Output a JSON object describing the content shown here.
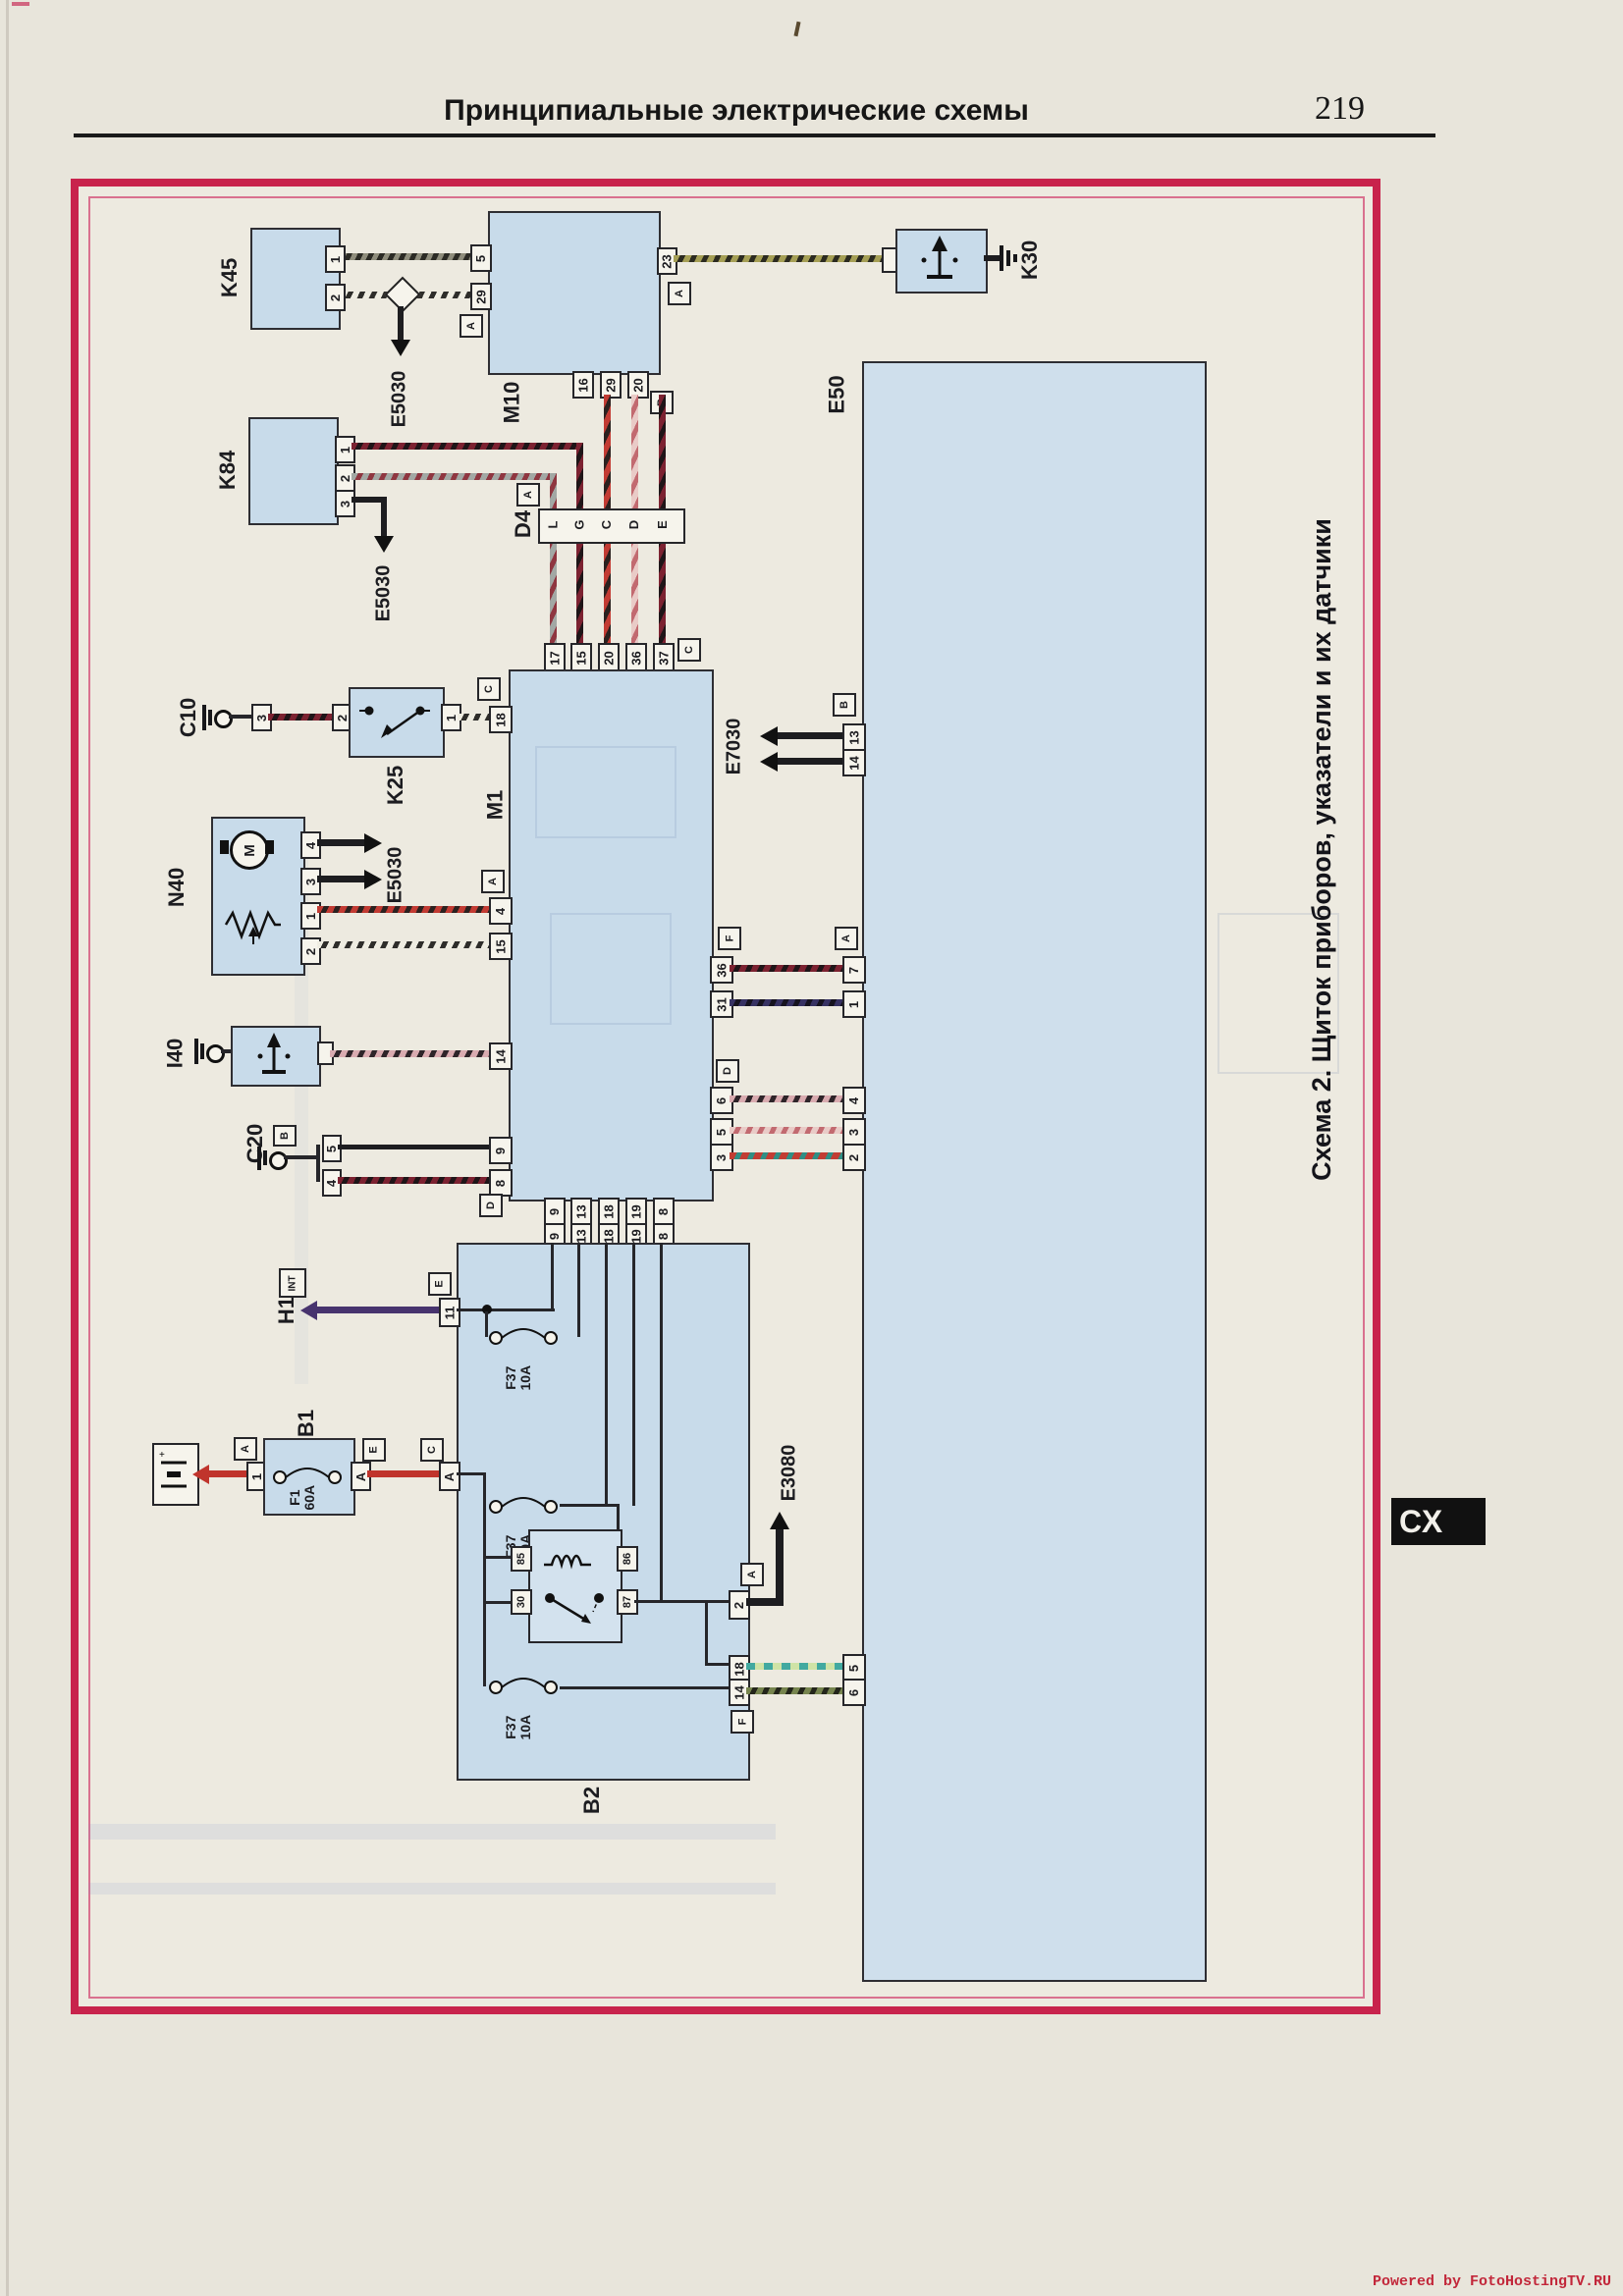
{
  "page": {
    "header_title": "Принципиальные электрические схемы",
    "page_number": "219",
    "caption": "Схема 2. Щиток приборов, указатели и их датчики",
    "cx_badge": "СХ",
    "watermark": "Powered by FotoHostingTV.RU"
  },
  "components": {
    "k45": "K45",
    "m10": "M10",
    "k30": "K30",
    "k84": "K84",
    "d4": "D4",
    "m1": "M1",
    "k25": "K25",
    "c10": "C10",
    "n40": "N40",
    "i40": "I40",
    "c20": "C20",
    "e50": "E50",
    "b1": "B1",
    "b2": "B2",
    "h1": "H1"
  },
  "grounds": {
    "e5030": "E5030",
    "e7030": "E7030",
    "e3080": "E3080"
  },
  "fuses": {
    "f1_name": "F1",
    "f1_amp": "60A",
    "f37_name": "F37",
    "f37_amp": "10A"
  },
  "tags": {
    "a": "A",
    "b": "B",
    "c": "C",
    "d": "D",
    "e": "E",
    "f": "F",
    "int": "INT"
  },
  "symbols": {
    "motor": "M"
  },
  "pins": {
    "k45": [
      "1",
      "2"
    ],
    "m10_left": [
      "5",
      "29"
    ],
    "m10_right": [
      "23"
    ],
    "m10_bottom": [
      "16",
      "29",
      "20"
    ],
    "k84": [
      "1",
      "2",
      "3"
    ],
    "d4": [
      "L",
      "G",
      "C",
      "D",
      "E"
    ],
    "m1_top": [
      "17",
      "15",
      "20",
      "36",
      "37"
    ],
    "m1_left": [
      "18",
      "4",
      "15",
      "14",
      "9",
      "8"
    ],
    "m1_right": [
      "36",
      "31",
      "6",
      "5",
      "3"
    ],
    "m1_bottom": [
      "9",
      "13",
      "18",
      "19",
      "8"
    ],
    "b2_top": [
      "9",
      "13",
      "18",
      "19",
      "8"
    ],
    "b2_left": [
      "11",
      "A"
    ],
    "b2_right": [
      "2",
      "18",
      "14"
    ],
    "relay": [
      "85",
      "86",
      "30",
      "87"
    ],
    "k25": [
      "2",
      "1"
    ],
    "c10_conn": [
      "3"
    ],
    "n40": [
      "4",
      "3",
      "1",
      "2"
    ],
    "c20_conn": [
      "5",
      "4"
    ],
    "b1": [
      "1",
      "A"
    ],
    "e50_left": [
      "13",
      "14",
      "7",
      "1",
      "4",
      "3",
      "2",
      "5",
      "6"
    ]
  }
}
